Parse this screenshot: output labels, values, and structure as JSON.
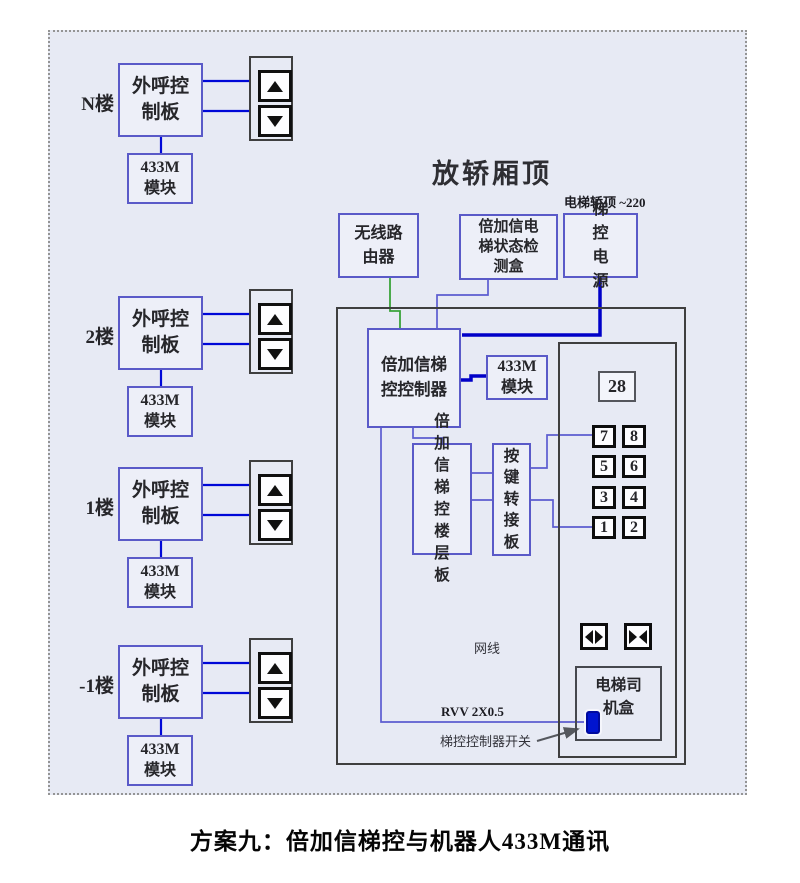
{
  "title": "方案九：倍加信梯控与机器人433M通讯",
  "car_top_title": "放轿厢顶",
  "power_note": "电梯轿顶 ~220",
  "floors": [
    {
      "label": "N楼",
      "board": "外呼控制板",
      "module_top": "433M",
      "module_bottom": "模块"
    },
    {
      "label": "2楼",
      "board": "外呼控制板",
      "module_top": "433M",
      "module_bottom": "模块"
    },
    {
      "label": "1楼",
      "board": "外呼控制板",
      "module_top": "433M",
      "module_bottom": "模块"
    },
    {
      "label": "-1楼",
      "board": "外呼控制板",
      "module_top": "433M",
      "module_bottom": "模块"
    }
  ],
  "car_top": {
    "router": "无线路由器",
    "detector": "倍加信电梯状态检测盒",
    "power": "梯控电源",
    "controller": "倍加信梯控控制器",
    "module_top": "433M",
    "module_bottom": "模块",
    "floor_board": "倍加信梯控楼层板",
    "key_adapter": "按键转接板"
  },
  "cop": {
    "floor_display": "28",
    "buttons": [
      "7",
      "8",
      "5",
      "6",
      "3",
      "4",
      "1",
      "2"
    ],
    "driver_box": "电梯司机盒"
  },
  "annotations": {
    "net_cable": "网线",
    "rvv": "RVV 2X0.5",
    "controller_switch": "梯控控制器开关"
  },
  "colors": {
    "canvas_bg": "#e7eaf4",
    "box_border": "#5a5ac8",
    "frame_border": "#3f3f3f",
    "wire_blue": "#0008d8",
    "wire_power": "#0000c8",
    "wire_green": "#3aa33a",
    "wire_violet": "#5c5cd0",
    "switch_blue": "#0014cf"
  }
}
